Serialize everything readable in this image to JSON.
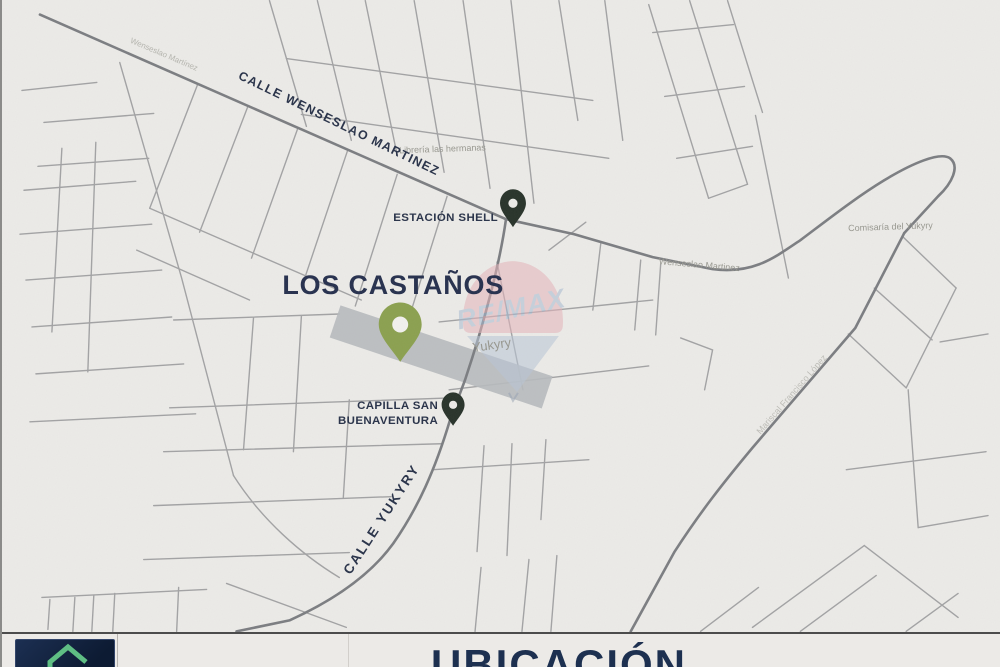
{
  "map": {
    "development_title": "LOS CASTAÑOS",
    "streets": {
      "wenseslao_martinez_main": "CALLE WENSESLAO MARTINEZ",
      "yukyry_main": "CALLE YUKYRY",
      "wenseslao_faint_west": "Wenseslao Martínez",
      "wenseslao_faint_east": "Wenseslao Martinez",
      "mariscal_faint": "Mariscal Francisco López"
    },
    "places": {
      "shell_station": "ESTACIÓN SHELL",
      "capilla_line1": "CAPILLA SAN",
      "capilla_line2": "BUENAVENTURA",
      "libreria": "Librería las hermanas",
      "comisaria": "Comisaría del Yukyry",
      "area_name": "Yukyry"
    },
    "watermark": {
      "brand": "RE/MAX"
    },
    "colors": {
      "paper": "#ecebe8",
      "road_minor": "#9a9b9d",
      "road_major": "#7b7d81",
      "parcel_gray": "#b7babe",
      "pin_dark": "#273229",
      "pin_olive": "#8ba04f",
      "label_navy": "#273148",
      "balloon_pink": "#e5b4ba",
      "balloon_blue": "#b9c6d6",
      "watermark_text": "#a8bad2"
    }
  },
  "footer": {
    "title": "UBICACIÓN",
    "logo": {
      "icon": "house-icon",
      "background": "#13213d",
      "icon_color": "#5fbe84"
    }
  }
}
